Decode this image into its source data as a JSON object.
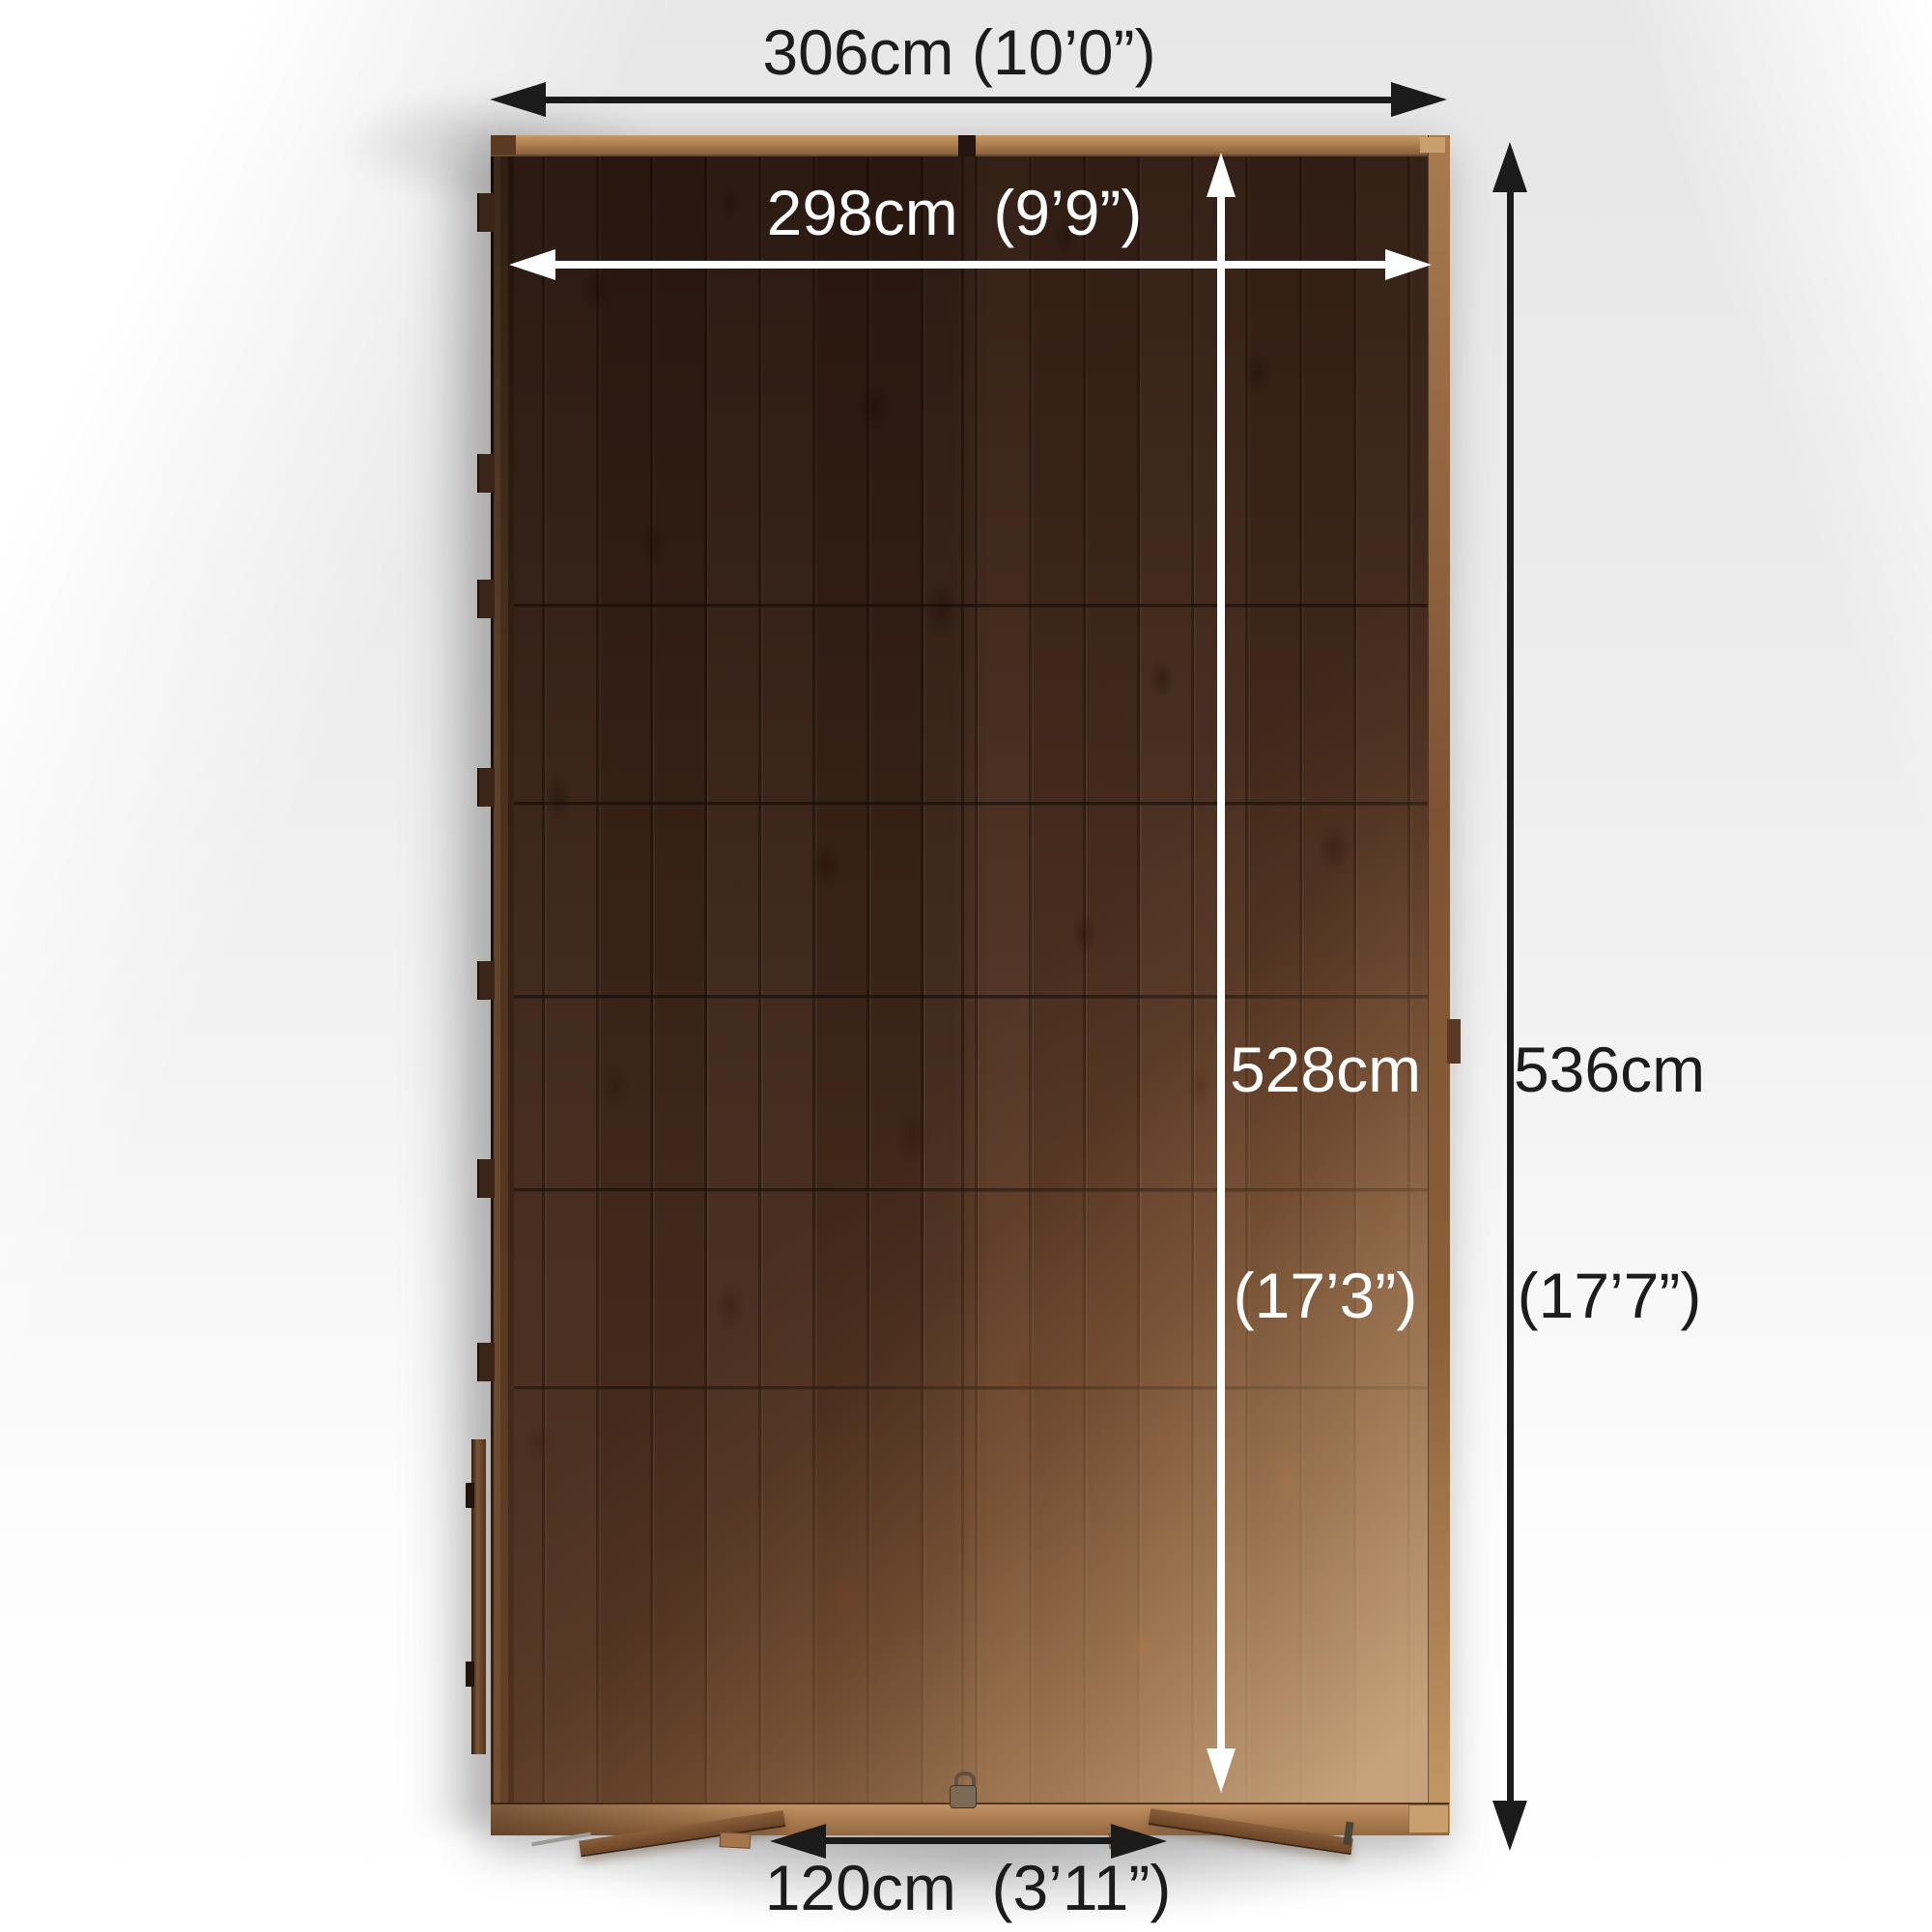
{
  "diagram": {
    "labels": {
      "outer_width": "306cm (10’0”)",
      "inner_width": "298cm  (9’9”)",
      "inner_depth_value": "528cm",
      "inner_depth_imperial": "(17’3”)",
      "outer_depth_value": "536cm",
      "outer_depth_imperial": "(17’7”)",
      "door_width": "120cm  (3’11”)"
    },
    "colors": {
      "arrow_black": "#1b1b1b",
      "arrow_white": "#ffffff",
      "wood_dark": "#44291c",
      "wood_light_patch": "#c49a67",
      "frame_tan": "#b0804f",
      "background": "#ececec"
    }
  }
}
